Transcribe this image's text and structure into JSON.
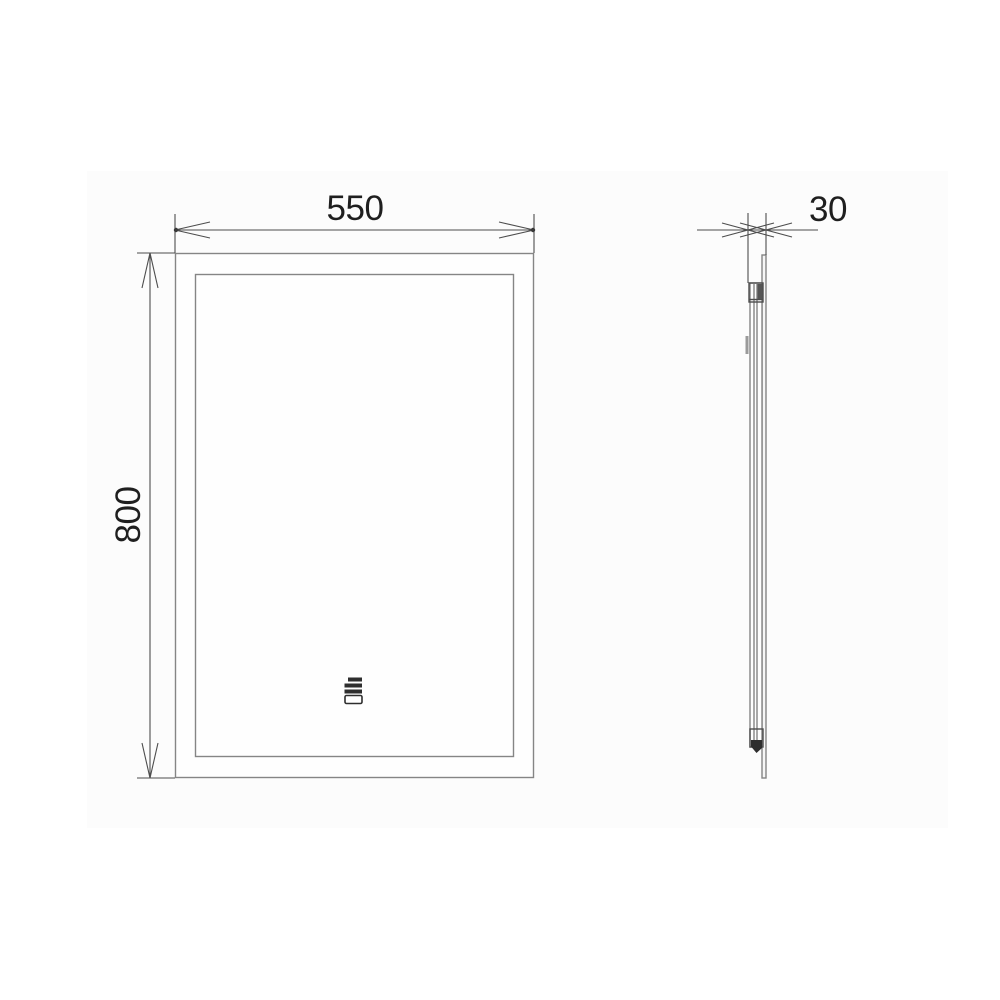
{
  "drawing": {
    "dimensions": {
      "width_label": "550",
      "height_label": "800",
      "depth_label": "30"
    },
    "colors": {
      "object_line": "#858585",
      "dimension_line": "#4d4d4d",
      "text": "#1f1f1f",
      "icon_dark": "#2e2e2e",
      "canvas_tint": "#fcfcfc",
      "background": "#ffffff"
    },
    "icons": {
      "front_panel_icon": "touch-switch-icon"
    }
  }
}
